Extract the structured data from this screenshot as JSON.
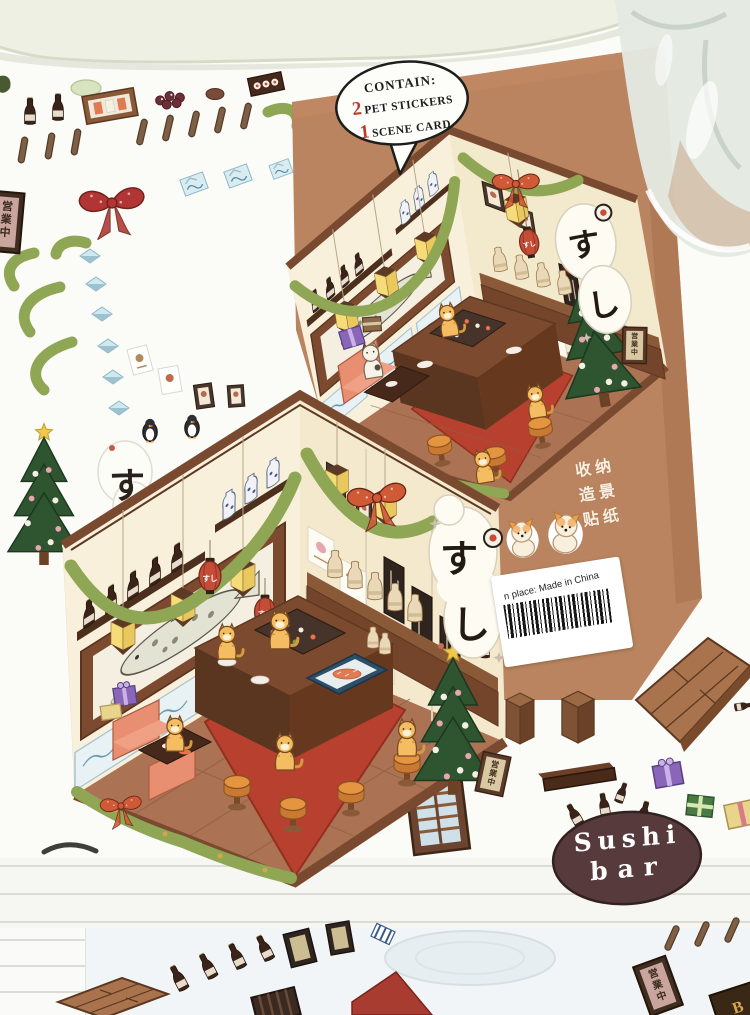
{
  "photo": {
    "bubble_contain": {
      "title": "CONTAIN:",
      "pet_count": "2",
      "pet_label": "PET STICKERS",
      "scene_count": "1",
      "scene_label": "SCENE CARD"
    },
    "envelope": {
      "vertical_lines": [
        "收纳",
        "造景",
        "贴纸"
      ],
      "origin_label": "n place: Made in China"
    },
    "bubble_sushi": {
      "line1": "Sushi",
      "line2": "bar"
    },
    "scene": {
      "banner_char1": "す",
      "banner_char2": "し",
      "lantern_text": "すし",
      "open_sign_chars": [
        "営",
        "業",
        "中"
      ],
      "corner_sign_text": "B"
    },
    "colors": {
      "envelope_kraft": "#b9845f",
      "card_wall": "#f8efda",
      "garland_green": "#8aa251",
      "carpet_red": "#b7402e",
      "bubble_maroon": "#573a3c",
      "accent_red": "#c0392b"
    }
  }
}
